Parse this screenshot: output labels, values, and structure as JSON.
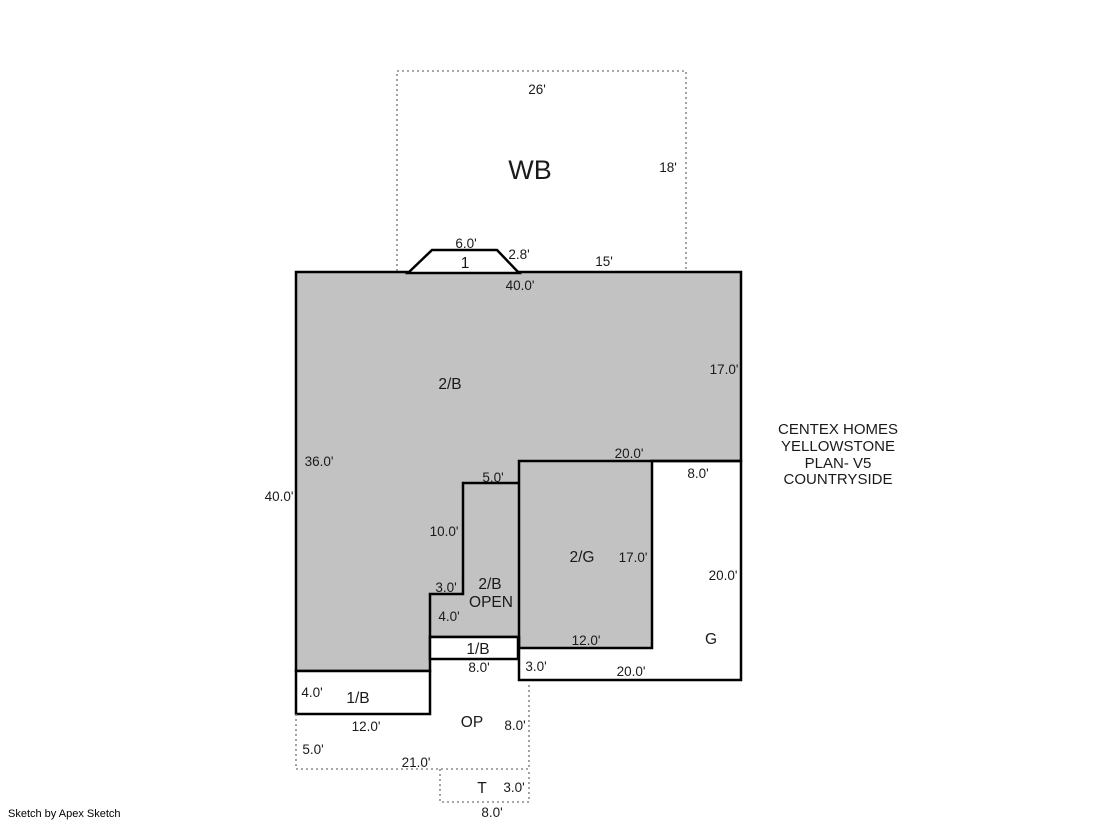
{
  "colors": {
    "area_fill": "#c2c2c2",
    "outline": "#000000",
    "dashed_line": "#8c8c8c",
    "background": "#ffffff"
  },
  "wood_deck": {
    "label": "WB",
    "dim_top": "26'",
    "dim_right": "18'"
  },
  "entry_stoop": {
    "label": "1",
    "dim_top": "6.0'",
    "dim_slope": "2.8'"
  },
  "main_house": {
    "label": "2/B",
    "dim_top": "40.0'",
    "dim_top_right_segment": "15'",
    "dim_right": "17.0'",
    "dim_left_inner": "36.0'",
    "dim_left_outer": "40.0'"
  },
  "open_area": {
    "label_line1": "2/B",
    "label_line2": "OPEN",
    "dim_top": "5.0'",
    "dim_left": "10.0'",
    "dim_step_horizontal": "3.0'",
    "dim_step_vertical": "4.0'"
  },
  "upper_garage": {
    "label": "2/G",
    "dim_top": "20.0'",
    "dim_right": "17.0'",
    "dim_bottom": "12.0'"
  },
  "garage": {
    "label": "G",
    "dim_top": "8.0'",
    "dim_right": "20.0'",
    "dim_left": "3.0'",
    "dim_bottom": "20.0'"
  },
  "strip_1b": {
    "label": "1/B",
    "dim_bottom": "8.0'"
  },
  "lower_1b": {
    "label": "1/B",
    "dim_left": "4.0'",
    "dim_bottom": "12.0'"
  },
  "open_porch": {
    "label": "OP",
    "dim_right": "8.0'",
    "dim_left": "5.0'",
    "dim_bottom": "21.0'"
  },
  "terrace_stoop": {
    "label": "T",
    "dim_right": "3.0'",
    "dim_bottom": "8.0'"
  },
  "annotation": {
    "line1": "CENTEX HOMES",
    "line2": "YELLOWSTONE",
    "line3": "PLAN- V5",
    "line4": "COUNTRYSIDE"
  },
  "footer": {
    "credit": "Sketch by Apex Sketch"
  }
}
